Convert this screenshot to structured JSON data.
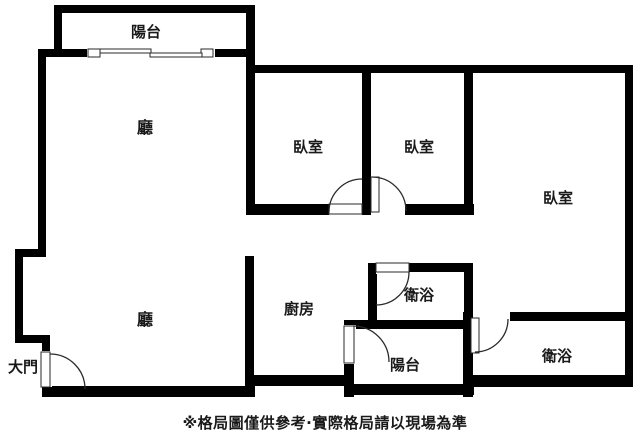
{
  "colors": {
    "wall": "#000000",
    "background": "#ffffff",
    "text": "#1a1a1a",
    "door_line": "#2a2a2a"
  },
  "labels": {
    "balcony_top": "陽台",
    "living_upper": "廳",
    "bedroom_1": "臥室",
    "bedroom_2": "臥室",
    "bedroom_3": "臥室",
    "living_lower": "廳",
    "kitchen": "廚房",
    "bathroom_1": "衛浴",
    "balcony_bottom": "陽台",
    "bathroom_2": "衛浴",
    "entrance": "大門"
  },
  "caption": "※格局圖僅供參考·實際格局請以現場為準"
}
